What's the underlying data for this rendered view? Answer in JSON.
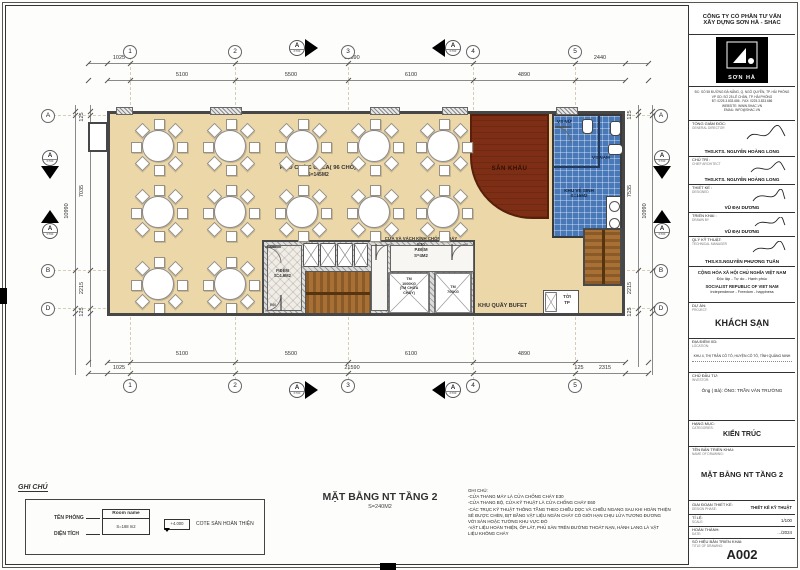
{
  "grid": {
    "cols": [
      "1",
      "2",
      "3",
      "4",
      "5"
    ],
    "rows": [
      "A",
      "B",
      "D"
    ],
    "section": "A",
    "section_sub": "KT00"
  },
  "dims": {
    "top": {
      "ext_left": "1025",
      "segments": [
        "5100",
        "5500",
        "6100",
        "4890"
      ],
      "total": "21590",
      "ext_right": "2440"
    },
    "bottom": {
      "ext_left": "1025",
      "segments": [
        "5100",
        "5500",
        "6100",
        "4890"
      ],
      "total": "21590",
      "ext_right_small": "125",
      "ext_right": "2315"
    },
    "left": {
      "top_small": "125",
      "upper": "7035",
      "total": "10990",
      "lower": "2215",
      "bottom_small": "125"
    },
    "right": {
      "top_small": "125",
      "upper": "7535",
      "total": "10990",
      "lower": "2215",
      "bottom_small": "125"
    }
  },
  "plan": {
    "gala_name": "P.TỔ CHỨC GALA( 96 CHỖ)",
    "gala_area": "S=145M2",
    "stage": "SÂN KHẤU",
    "wc_area_name": "KHU VỆ SINH",
    "wc_area_size": "S=16M2",
    "wc_female": "VS NỮ",
    "wc_male": "VS NAM",
    "buffet": "KHU QUẦY BUFET",
    "hoist_l1": "TỜI",
    "hoist_l2": "TP",
    "pdem_left_name": "P.ĐỆM",
    "pdem_left_area": "S=4.6M2",
    "door_e60_top": "E60",
    "door_e60_bottom": "E60",
    "glass_note": "CỬA VÀ VÁCH KÍNH CHỐNG CHÁY",
    "glass_e30": "E30",
    "pdem_right_name": "P.ĐỆM",
    "pdem_right_area": "S=4M2",
    "lift1_l1": "TM",
    "lift1_l2": "1000KG",
    "lift1_l3": "(TM CHỮA",
    "lift1_l4": "CHÁY)",
    "lift2_l1": "TM",
    "lift2_l2": "700KG"
  },
  "caption": {
    "title": "MẶT BẰNG NT TẦNG 2",
    "area": "S=240M2"
  },
  "legend": {
    "title": "GHI CHÚ",
    "room_name_label": "TÊN PHÒNG",
    "area_label": "DIỆN TÍCH",
    "room_name_value": "Room name",
    "area_value": "S=168 m2",
    "level_value": "+4.000",
    "level_label": "COTE SÀN HOÀN THIỆN"
  },
  "notes": {
    "title": "GHI CHÚ:",
    "lines": [
      "-CỬA THANG MÁY LÀ CỬA CHỐNG CHÁY E30",
      "-CỬA THANG BỘ, CỬA KỸ THUẬT LÀ CỬA CHỐNG CHÁY E60",
      "-CÁC TRỤC KỸ THUẬT THÔNG TẦNG THEO CHIỀU DỌC VÀ CHIỀU NGANG SAU KHI HOÀN THIỆN",
      "SẼ ĐƯỢC CHÈN, BỊT BẰNG VẬT LIỆU NGĂN CHÁY CÓ GIỚI HẠN CHỊU LỬA TƯƠNG ĐƯƠNG",
      "VỚI SÀN HOẶC TƯỜNG KHU VỰC ĐÓ",
      "-VẬT LIỆU HOÀN THIỆN, ỐP LÁT, PHỦ SÀN TRÊN ĐƯỜNG THOÁT NẠN, HÀNH LANG LÀ VẬT",
      "LIỆU KHÔNG CHÁY"
    ]
  },
  "title_block": {
    "company_line1": "CÔNG TY CỔ PHẦN TƯ VẤN",
    "company_line2": "XÂY DỰNG SƠN HÀ - SHAC",
    "logo_text": "SƠN HÀ",
    "address_lines": [
      "ĐC: SỐ 55 ĐƯỜNG ĐÀ NẴNG, Q. NGÔ QUYỀN, TP. HẢI PHÒNG",
      "VP GD: SỐ 25 LÊ CHÂN, TP. HẢI PHÒNG",
      "ĐT: 0225.3.833.686 - FAX: 0225.3.833.686",
      "WEBSITE: WWW.SHAC.VN",
      "EMAIL: INFO@SHAC.VN"
    ],
    "roles": [
      {
        "label": "TỔNG GIÁM ĐỐC:",
        "label_en": "GENERAL DIRECTOR",
        "name": "THS.KTS. NGUYỄN HOÀNG LONG"
      },
      {
        "label": "CHỦ TRÌ :",
        "label_en": "CHIEF ARCHITECT",
        "name": "THS.KTS. NGUYỄN HOÀNG LONG"
      },
      {
        "label": "THIẾT KẾ :",
        "label_en": "DESIGNED",
        "name": "VŨ ĐẠI DƯƠNG"
      },
      {
        "label": "TRIỂN KHAI :",
        "label_en": "DRAWN BY",
        "name": "VŨ ĐẠI DƯƠNG"
      },
      {
        "label": "QLÝ KỸ THUẬT:",
        "label_en": "TECHNICAL MANAGER",
        "name": "THS.KS.NGUYỄN PHƯƠNG TUẤN"
      }
    ],
    "republic_lines": [
      "CỘNG HÒA XÃ HỘI CHỦ NGHĨA VIỆT NAM",
      "Độc lập - Tự do - Hạnh phúc",
      "SOCIALIST REPUBLIC OF VIET NAM",
      "Independence - Freedom - happiness"
    ],
    "project_label": "DỰ ÁN:",
    "project_label_en": "PROJECT:",
    "project_value": "KHÁCH SẠN",
    "location_label": "ĐỊA ĐIỂM XD:",
    "location_label_en": "LOCATION:",
    "location_value": "KHU 4, THỊ TRẤN CÔ TÔ, HUYỆN CÔ TÔ, TỈNH QUẢNG NINH",
    "investor_label": "CHỦ ĐẦU TƯ:",
    "investor_label_en": "INVESTOR:",
    "investor_value": "Ông ( Bà): ÔNG: TRẦN VĂN TRƯỜNG",
    "category_label": "HẠNG MỤC:",
    "category_label_en": "CATEGORIES:",
    "category_value": "KIẾN TRÚC",
    "drawing_name_label": "TÊN BẢN TRIỂN KHAI:",
    "drawing_name_label_en": "NAME OF DRAWING:",
    "drawing_name_value": "MẶT BẰNG NT TẦNG 2",
    "phase_label": "GIAI ĐOẠN THIẾT KẾ:",
    "phase_label_en": "DESIGN PHASE:",
    "phase_value": "THIẾT KẾ KỸ THUẬT",
    "scale_label": "TỈ LỆ:",
    "scale_label_en": "SCALE:",
    "scale_value": "1/100",
    "date_label": "HOÀN THÀNH:",
    "date_label_en": "DATE:",
    "date_value": ".../2024",
    "number_label": "SỐ HIỆU BẢN TRIỂN KHAI:",
    "number_label_en": "TITLE OF DRAWING:",
    "number_value": "A002"
  }
}
